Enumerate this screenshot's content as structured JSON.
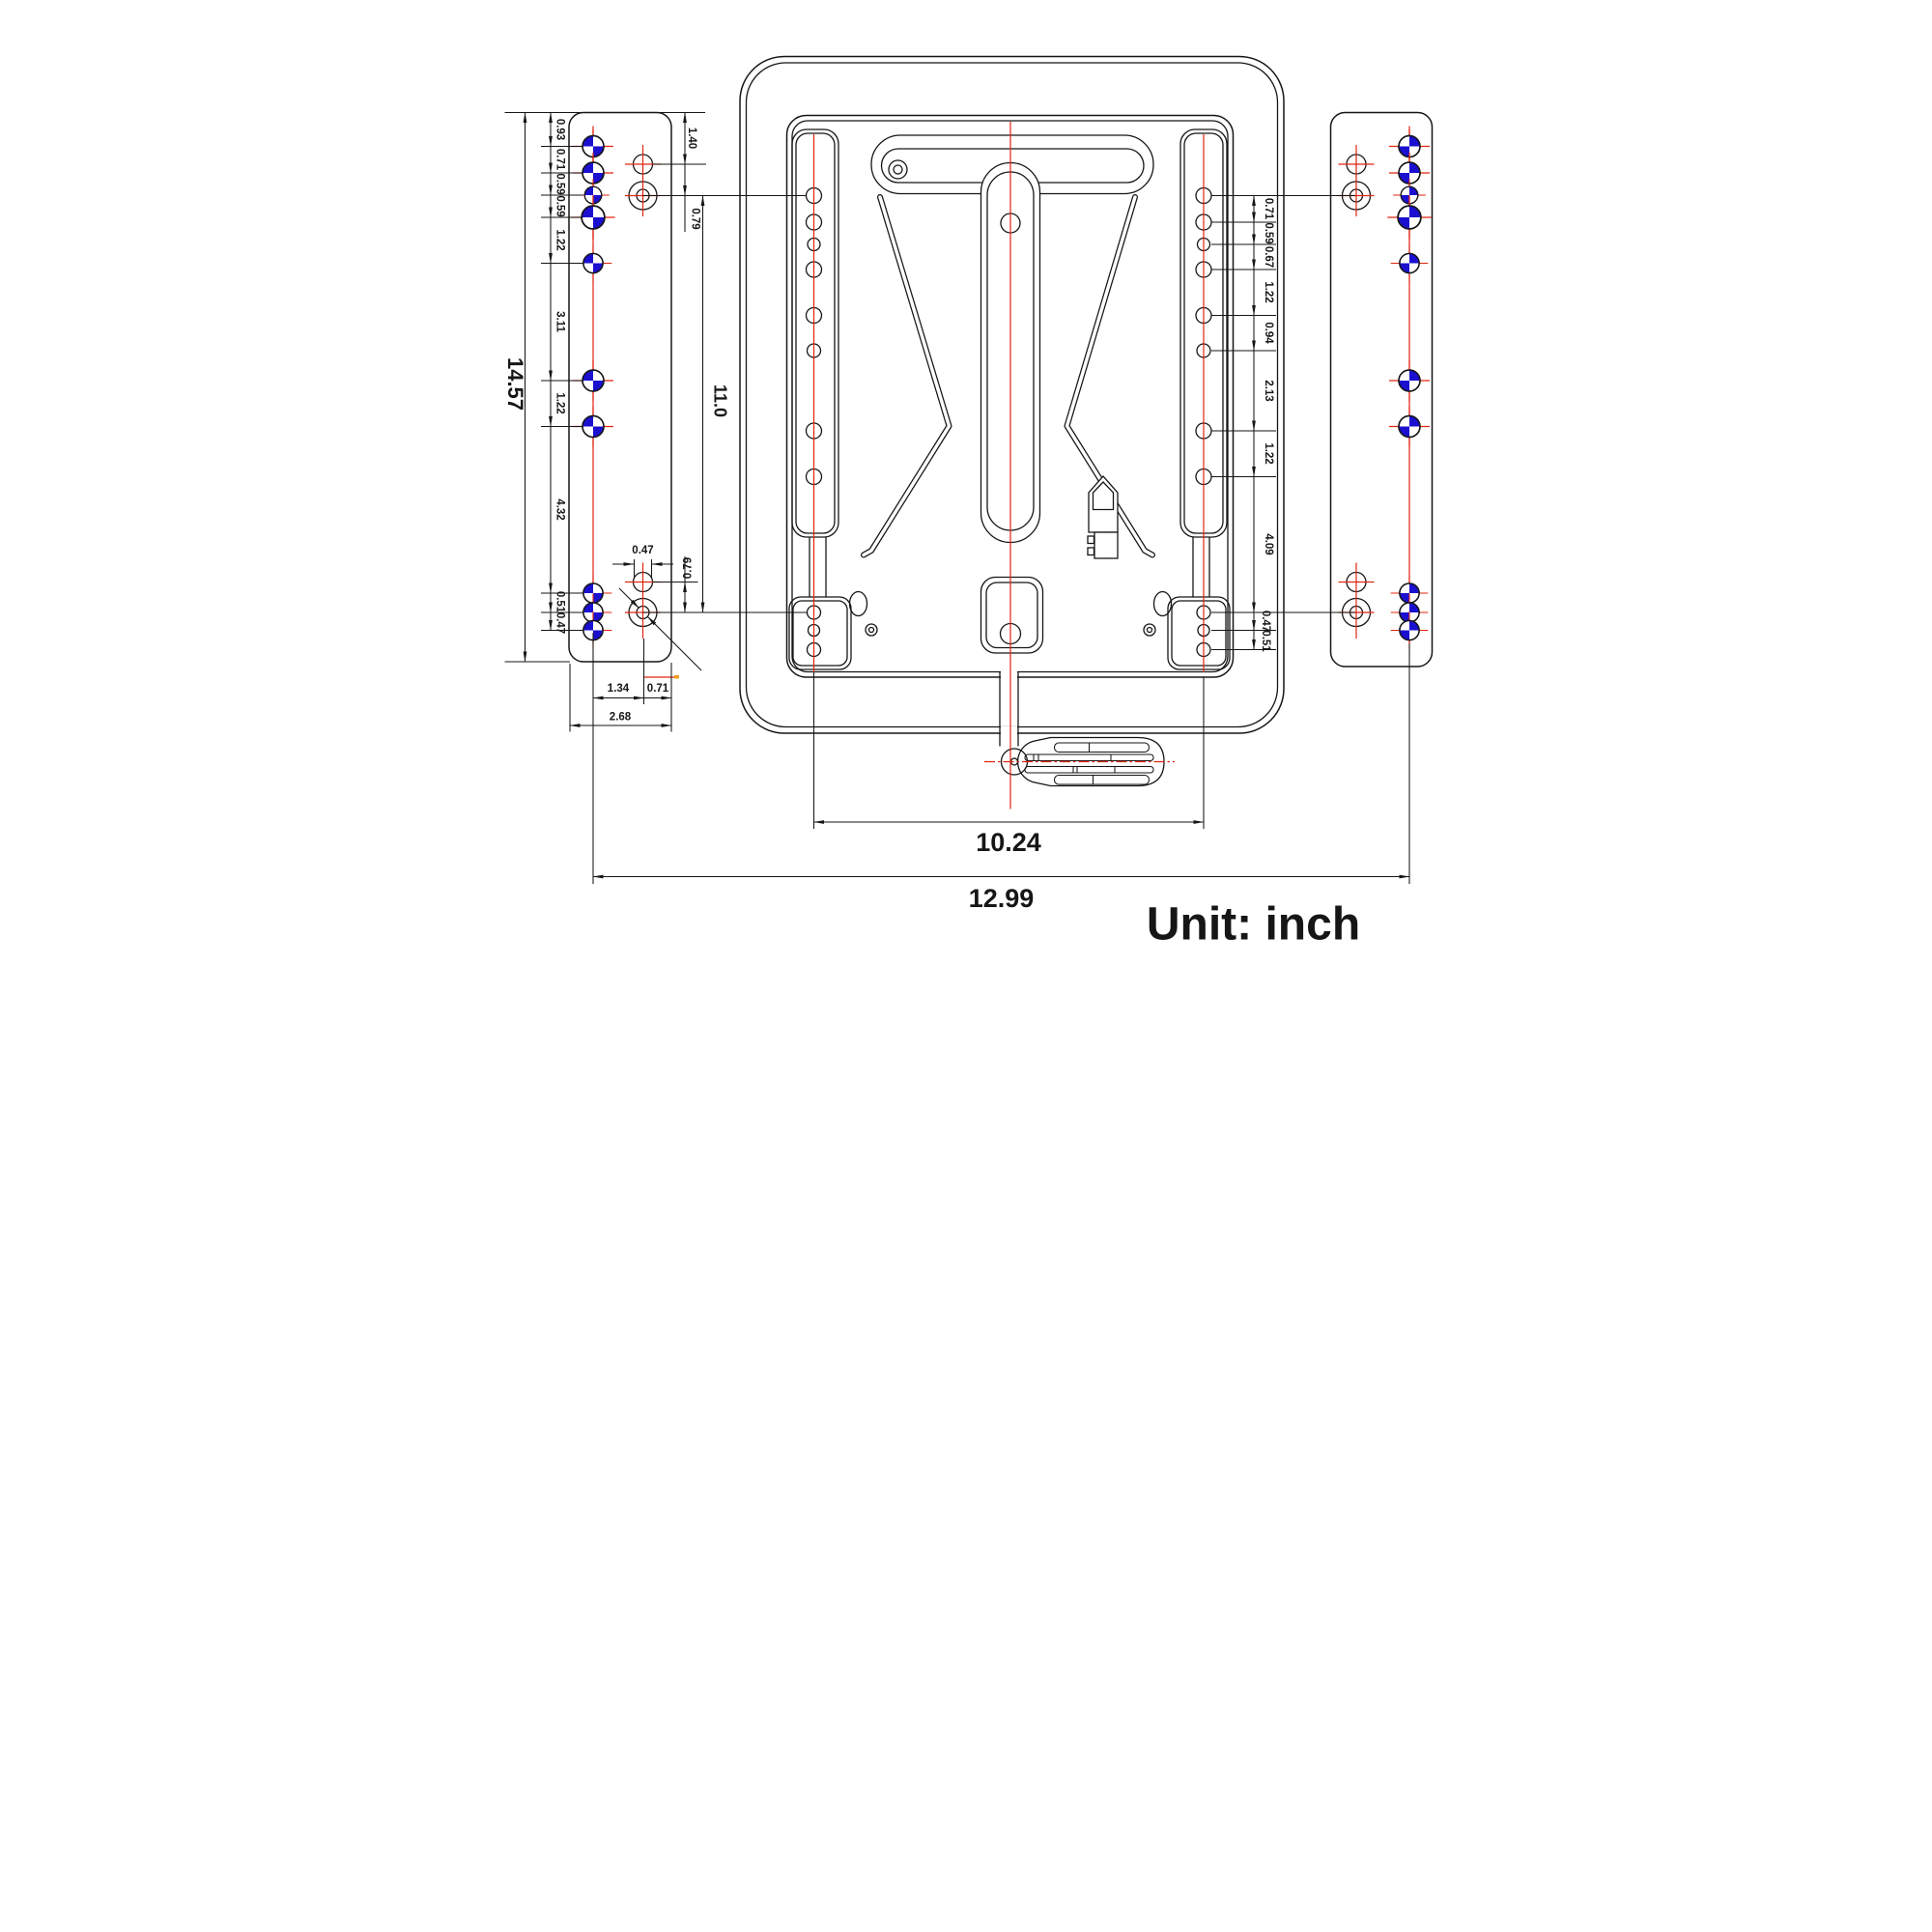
{
  "drawing": {
    "unit_label": "Unit: inch",
    "dims": {
      "overall_height": "14.57",
      "rail_center_height": "11.0",
      "rail_span": "10.24",
      "overall_span": "12.99",
      "left_chain": [
        "0.93",
        "0.71",
        "0.59",
        "0.59",
        "1.22",
        "3.11",
        "1.22",
        "4.32",
        "0.51",
        "0.47"
      ],
      "left_top_edge_to_hole": "1.40",
      "left_hole_pair_gap_top": "0.79",
      "left_slot_width": "0.47",
      "left_hole_pair_gap_bottom": "0.79",
      "left_hole_to_center": "1.34",
      "left_center_to_edge": "0.71",
      "left_plate_width": "2.68",
      "right_chain": [
        "0.71",
        "0.59",
        "0.67",
        "1.22",
        "0.94",
        "2.13",
        "1.22",
        "4.09",
        "0.47",
        "0.51"
      ]
    },
    "colors": {
      "line": "#161616",
      "centerline_red": "#e02511",
      "datum_blue": "#1b10cf",
      "highlight_orange": "#f0a020",
      "background": "#ffffff"
    }
  }
}
